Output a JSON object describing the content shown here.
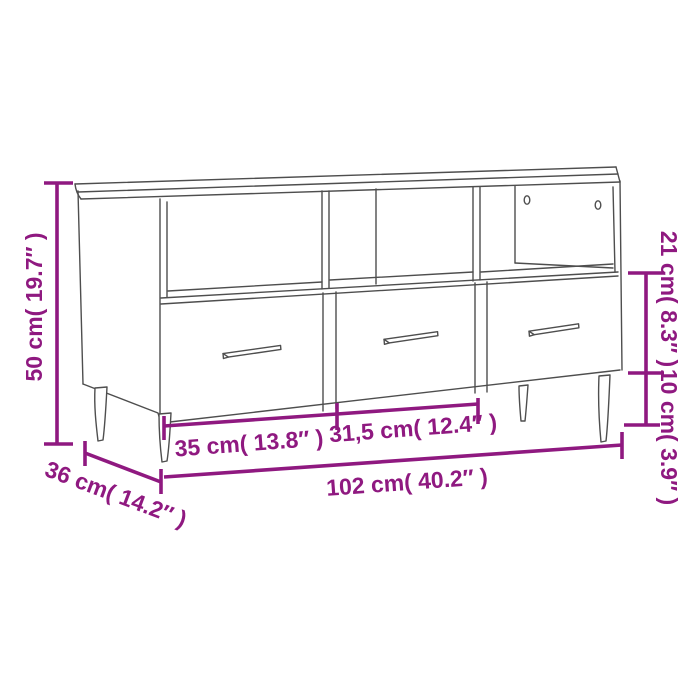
{
  "diagram": {
    "type": "furniture-dimension-diagram",
    "subject": "TV cabinet with 3 open compartments, 3 drawers and 4 metal legs",
    "background": "#ffffff",
    "line_color": "#4e4e4e",
    "accent_color": "#8F1980",
    "labels": {
      "height": "50 cm( 19.7″ )",
      "depth": "36 cm( 14.2″ )",
      "left_compartment_width": "35 cm( 13.8″ )",
      "middle_compartment_width": "31,5 cm( 12.4″ )",
      "total_width": "102 cm( 40.2″ )",
      "drawer_section_height": "21 cm( 8.3″ )",
      "leg_height": "10 cm( 3.9″ )"
    },
    "values": {
      "height_cm": 50,
      "height_in": 19.7,
      "depth_cm": 36,
      "depth_in": 14.2,
      "left_compartment_cm": 35,
      "left_compartment_in": 13.8,
      "middle_compartment_cm": 31.5,
      "middle_compartment_in": 12.4,
      "total_width_cm": 102,
      "total_width_in": 40.2,
      "drawer_section_cm": 21,
      "drawer_section_in": 8.3,
      "leg_height_cm": 10,
      "leg_height_in": 3.9
    }
  }
}
